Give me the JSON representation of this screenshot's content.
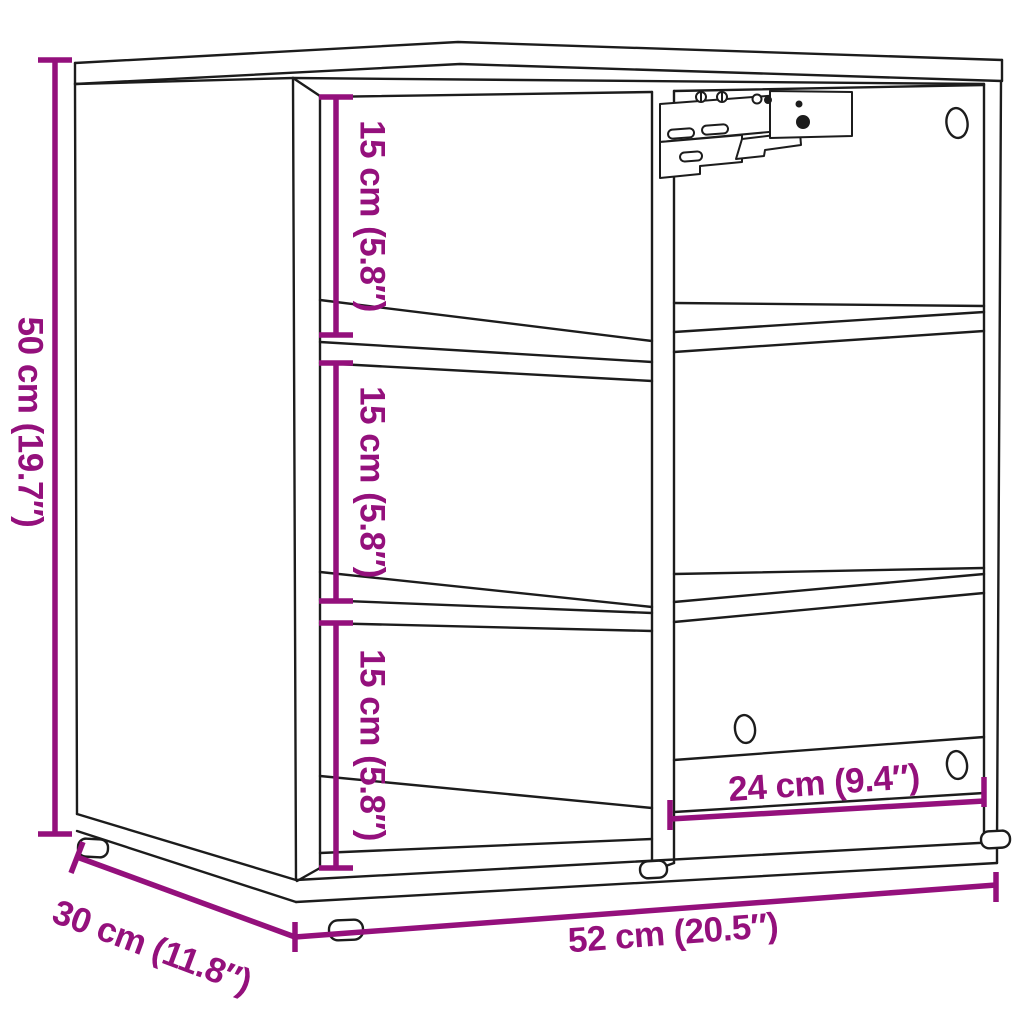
{
  "title": "Shelving cabinet dimension diagram",
  "colors": {
    "dimension_annotation": "#94107C",
    "outline": "#1C1C1C",
    "background": "#FFFFFF"
  },
  "dimensions": {
    "height": {
      "label": "50 cm (19.7″)",
      "cm": 50,
      "inches": 19.7
    },
    "width": {
      "label": "52 cm (20.5″)",
      "cm": 52,
      "inches": 20.5
    },
    "depth": {
      "label": "30 cm (11.8″)",
      "cm": 30,
      "inches": 11.8
    },
    "compartment_top": {
      "label": "15 cm (5.8″)",
      "cm": 15,
      "inches": 5.8
    },
    "compartment_middle": {
      "label": "15 cm (5.8″)",
      "cm": 15,
      "inches": 5.8
    },
    "compartment_bottom": {
      "label": "15 cm (5.8″)",
      "cm": 15,
      "inches": 5.8
    },
    "compartment_width": {
      "label": "24 cm (9.4″)",
      "cm": 24,
      "inches": 9.4
    }
  },
  "figure": {
    "description": "Open shelving cabinet, two columns by three rows of compartments, wall-mount bracket hardware at top of center divider, oval cable holes in right side and bottom-right compartment, four round feet"
  }
}
